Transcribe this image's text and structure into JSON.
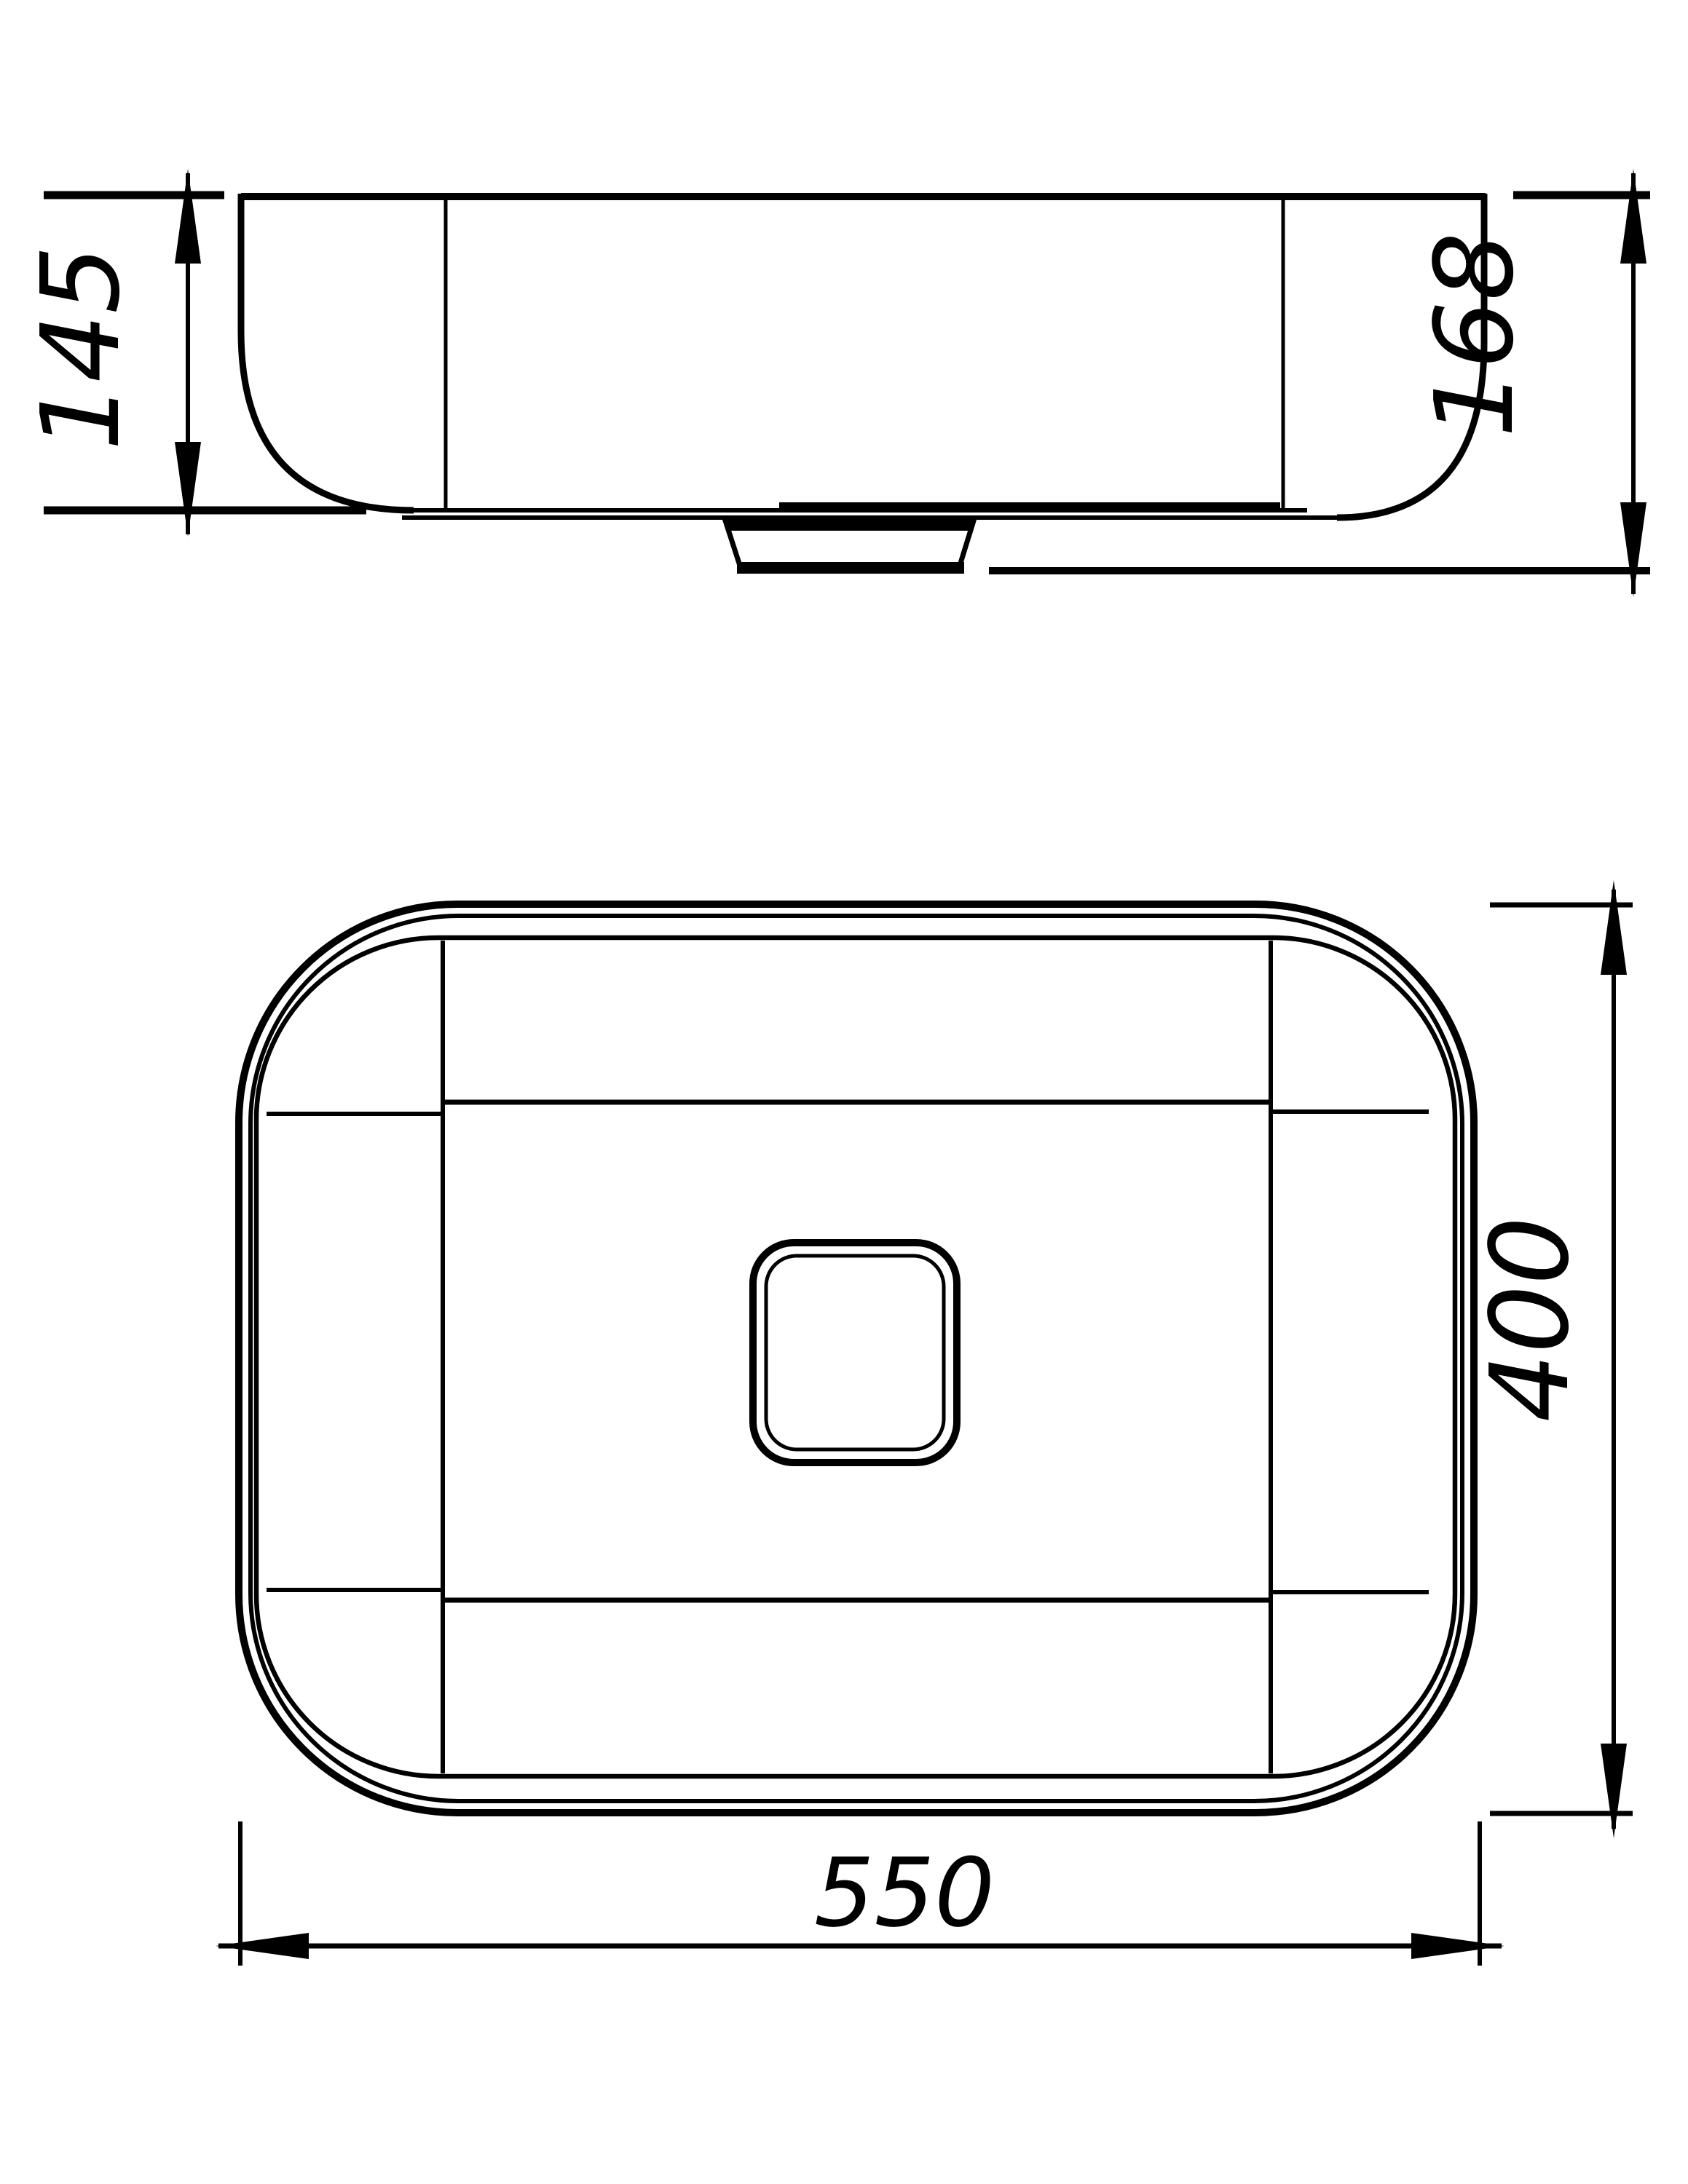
{
  "drawing": {
    "background_color": "#ffffff",
    "line_color": "#000000",
    "views": {
      "side": {
        "dimensions": {
          "basin_height": "145",
          "overall_height": "168"
        }
      },
      "plan": {
        "dimensions": {
          "depth": "400",
          "width": "550"
        }
      }
    }
  }
}
